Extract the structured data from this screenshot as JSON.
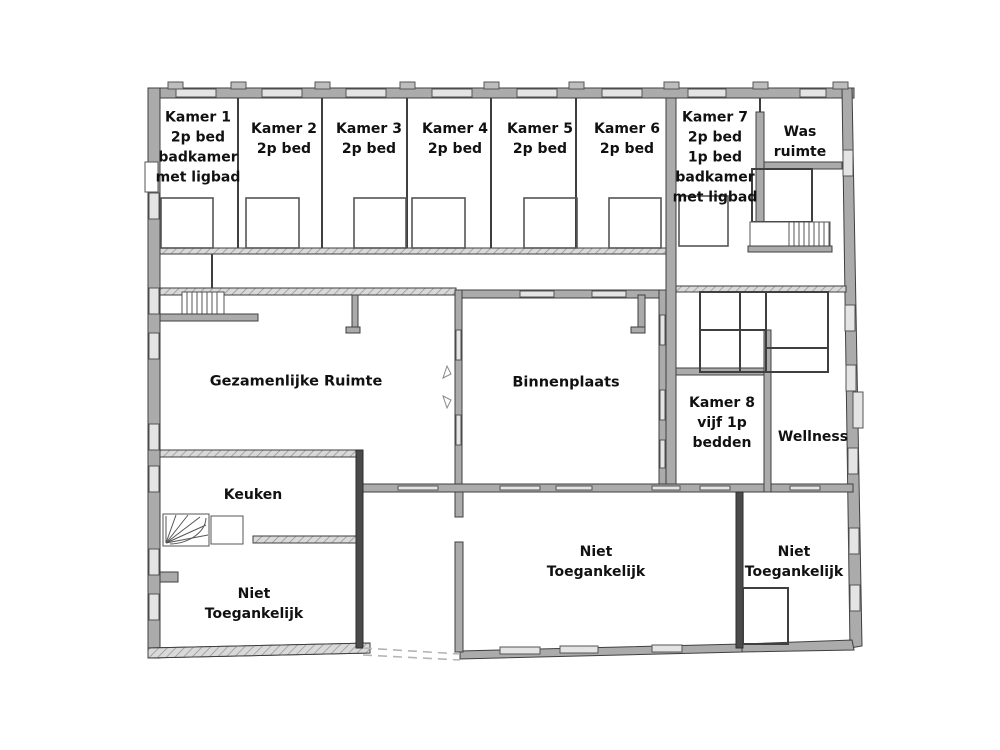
{
  "floorplan": {
    "background": "#ffffff",
    "wall_fill": "#ababab",
    "wall_dark": "#4a4a4a",
    "outline": "#3f3f3f",
    "window_fill": "#e4e4e4",
    "label_color": "#111111",
    "rooms": [
      {
        "id": "kamer-1",
        "label": "Kamer 1\n2p bed\nbadkamer\nmet ligbad"
      },
      {
        "id": "kamer-2",
        "label": "Kamer 2\n2p bed"
      },
      {
        "id": "kamer-3",
        "label": "Kamer 3\n2p bed"
      },
      {
        "id": "kamer-4",
        "label": "Kamer 4\n2p bed"
      },
      {
        "id": "kamer-5",
        "label": "Kamer 5\n2p bed"
      },
      {
        "id": "kamer-6",
        "label": "Kamer 6\n2p bed"
      },
      {
        "id": "kamer-7",
        "label": "Kamer 7\n2p bed\n1p bed\nbadkamer\nmet ligbad"
      },
      {
        "id": "was-ruimte",
        "label": "Was\nruimte"
      },
      {
        "id": "gezamenlijke-ruimte",
        "label": "Gezamenlijke Ruimte"
      },
      {
        "id": "binnenplaats",
        "label": "Binnenplaats"
      },
      {
        "id": "kamer-8",
        "label": "Kamer 8\nvijf 1p\nbedden"
      },
      {
        "id": "wellness",
        "label": "Wellness"
      },
      {
        "id": "keuken",
        "label": "Keuken"
      },
      {
        "id": "niet-toegankelijk-links",
        "label": "Niet\nToegankelijk"
      },
      {
        "id": "niet-toegankelijk-midden",
        "label": "Niet\nToegankelijk"
      },
      {
        "id": "niet-toegankelijk-rechts",
        "label": "Niet\nToegankelijk"
      }
    ]
  }
}
